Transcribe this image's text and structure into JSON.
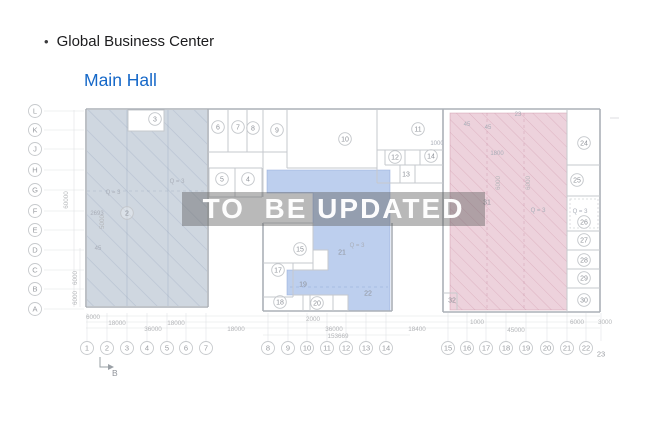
{
  "header": {
    "bullet": "•",
    "title": "Global Business Center",
    "subtitle": "Main Hall"
  },
  "watermark": {
    "text": "TO  BE UPDATED"
  },
  "colors": {
    "subtitle_blue": "#1668c8",
    "left_zone_fill": "#cfd7e0",
    "center_zone_fill": "#bdcfee",
    "right_zone_fill": "#edd2dc",
    "watermark_band": "rgba(95,95,95,0.44)",
    "watermark_text": "#ffffff"
  },
  "plan": {
    "axis": {
      "letters_x": 35,
      "numbers_y": 348,
      "letters": [
        {
          "t": "L",
          "y": 111
        },
        {
          "t": "K",
          "y": 130
        },
        {
          "t": "J",
          "y": 149
        },
        {
          "t": "H",
          "y": 170
        },
        {
          "t": "G",
          "y": 190
        },
        {
          "t": "F",
          "y": 211
        },
        {
          "t": "E",
          "y": 230
        },
        {
          "t": "D",
          "y": 250
        },
        {
          "t": "C",
          "y": 270
        },
        {
          "t": "B",
          "y": 289
        },
        {
          "t": "A",
          "y": 309
        }
      ],
      "numbers": [
        {
          "t": "1",
          "x": 87
        },
        {
          "t": "2",
          "x": 107
        },
        {
          "t": "3",
          "x": 127
        },
        {
          "t": "4",
          "x": 147
        },
        {
          "t": "5",
          "x": 167
        },
        {
          "t": "6",
          "x": 186
        },
        {
          "t": "7",
          "x": 206
        },
        {
          "t": "8",
          "x": 268
        },
        {
          "t": "9",
          "x": 288
        },
        {
          "t": "10",
          "x": 307
        },
        {
          "t": "11",
          "x": 327
        },
        {
          "t": "12",
          "x": 346
        },
        {
          "t": "13",
          "x": 366
        },
        {
          "t": "14",
          "x": 386
        },
        {
          "t": "15",
          "x": 448
        },
        {
          "t": "16",
          "x": 467
        },
        {
          "t": "17",
          "x": 486
        },
        {
          "t": "18",
          "x": 506
        },
        {
          "t": "19",
          "x": 526
        },
        {
          "t": "20",
          "x": 547
        },
        {
          "t": "21",
          "x": 567
        },
        {
          "t": "22",
          "x": 586
        },
        {
          "t": "23",
          "x": 601,
          "plain": true,
          "y": 354
        }
      ]
    },
    "rooms": {
      "circled": [
        {
          "n": "2",
          "x": 127,
          "y": 213
        },
        {
          "n": "3",
          "x": 155,
          "y": 119
        },
        {
          "n": "4",
          "x": 248,
          "y": 179
        },
        {
          "n": "5",
          "x": 222,
          "y": 179
        },
        {
          "n": "6",
          "x": 218,
          "y": 127
        },
        {
          "n": "7",
          "x": 238,
          "y": 127
        },
        {
          "n": "8",
          "x": 253,
          "y": 128
        },
        {
          "n": "9",
          "x": 277,
          "y": 130
        },
        {
          "n": "10",
          "x": 345,
          "y": 139
        },
        {
          "n": "11",
          "x": 418,
          "y": 129
        },
        {
          "n": "12",
          "x": 395,
          "y": 157
        },
        {
          "n": "14",
          "x": 431,
          "y": 156
        },
        {
          "n": "15",
          "x": 300,
          "y": 249
        },
        {
          "n": "17",
          "x": 278,
          "y": 270
        },
        {
          "n": "18",
          "x": 280,
          "y": 302
        },
        {
          "n": "20",
          "x": 317,
          "y": 303
        },
        {
          "n": "24",
          "x": 584,
          "y": 143
        },
        {
          "n": "25",
          "x": 577,
          "y": 180
        },
        {
          "n": "26",
          "x": 584,
          "y": 222
        },
        {
          "n": "27",
          "x": 584,
          "y": 240
        },
        {
          "n": "28",
          "x": 584,
          "y": 260
        },
        {
          "n": "29",
          "x": 584,
          "y": 278
        },
        {
          "n": "30",
          "x": 584,
          "y": 300
        }
      ],
      "plain": [
        {
          "n": "13",
          "x": 406,
          "y": 174
        },
        {
          "n": "19",
          "x": 303,
          "y": 284
        },
        {
          "n": "21",
          "x": 342,
          "y": 252
        },
        {
          "n": "22",
          "x": 368,
          "y": 293
        },
        {
          "n": "31",
          "x": 487,
          "y": 202
        },
        {
          "n": "32",
          "x": 452,
          "y": 300
        }
      ]
    },
    "annotations": [
      {
        "t": "Q = 3",
        "x": 113,
        "y": 192
      },
      {
        "t": "Q = 3",
        "x": 177,
        "y": 181
      },
      {
        "t": "2693",
        "x": 97,
        "y": 213
      },
      {
        "t": "45",
        "x": 98,
        "y": 248
      },
      {
        "t": "23",
        "x": 518,
        "y": 114
      },
      {
        "t": "45",
        "x": 467,
        "y": 124
      },
      {
        "t": "45",
        "x": 488,
        "y": 127
      },
      {
        "t": "1000",
        "x": 437,
        "y": 143
      },
      {
        "t": "1800",
        "x": 497,
        "y": 153
      },
      {
        "t": "Q = 3",
        "x": 538,
        "y": 210
      },
      {
        "t": "Q = 3",
        "x": 580,
        "y": 211
      },
      {
        "t": "Q = 3",
        "x": 357,
        "y": 245
      }
    ],
    "dimensions": [
      {
        "t": "6000",
        "x": 93,
        "y": 319
      },
      {
        "t": "18000",
        "x": 117,
        "y": 325
      },
      {
        "t": "36000",
        "x": 153,
        "y": 331
      },
      {
        "t": "18000",
        "x": 176,
        "y": 325
      },
      {
        "t": "18000",
        "x": 236,
        "y": 331
      },
      {
        "t": "2000",
        "x": 313,
        "y": 321
      },
      {
        "t": "36000",
        "x": 334,
        "y": 331
      },
      {
        "t": "153669",
        "x": 338,
        "y": 338
      },
      {
        "t": "18400",
        "x": 417,
        "y": 331
      },
      {
        "t": "1000",
        "x": 477,
        "y": 324
      },
      {
        "t": "45000",
        "x": 516,
        "y": 332
      },
      {
        "t": "6000",
        "x": 577,
        "y": 324
      },
      {
        "t": "3000",
        "x": 605,
        "y": 324
      }
    ],
    "vertical_dims": [
      {
        "t": "60000",
        "x": 68,
        "y": 200
      },
      {
        "t": "6000",
        "x": 77,
        "y": 278
      },
      {
        "t": "6000",
        "x": 77,
        "y": 298
      },
      {
        "t": "5000",
        "x": 104,
        "y": 222
      },
      {
        "t": "6000",
        "x": 500,
        "y": 183
      },
      {
        "t": "6000",
        "x": 530,
        "y": 183
      }
    ],
    "section_marker": {
      "label": "B"
    }
  }
}
